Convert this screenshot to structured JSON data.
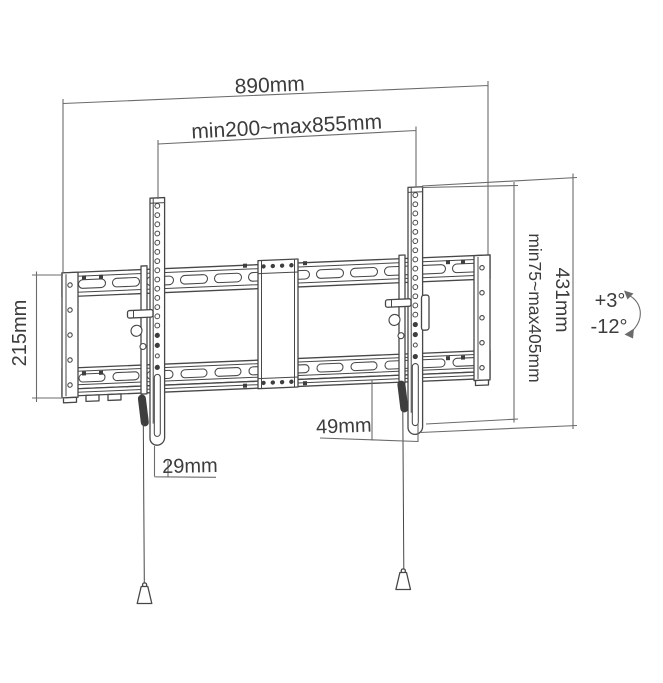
{
  "diagram": {
    "name": "Tilting TV wall mount dimensional drawing",
    "colors": {
      "outline": "#474747",
      "dimension_line": "#6b6b6b",
      "text": "#3c3c3c",
      "dark_fill": "#3e3e3e",
      "background": "#ffffff"
    },
    "labels": {
      "overall_width": "890mm",
      "arm_spread_range": "min200~max855mm",
      "wall_plate_height": "215mm",
      "vesa_height_range": "min75~max405mm",
      "bracket_height": "431mm",
      "arm_bottom_offset": "49mm",
      "wall_plate_depth": "29mm",
      "tilt_up": "+3°",
      "tilt_down": "-12°"
    }
  }
}
